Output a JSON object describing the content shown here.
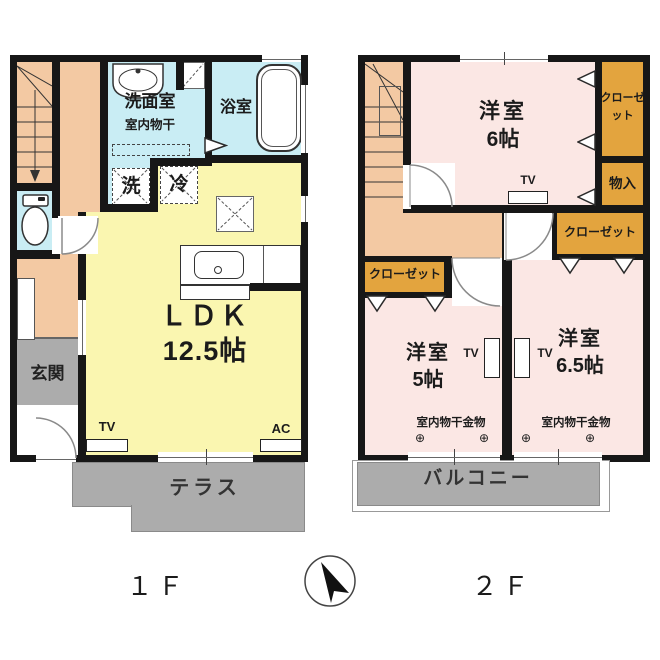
{
  "colors": {
    "wall": "#171717",
    "stairs_hall_fill": "#F3C9A3",
    "wet_area_fill": "#C9EDF4",
    "ldk_fill": "#FAF6B0",
    "bedroom_fill": "#FBE7E4",
    "closet_fill": "#E3A43E",
    "outdoor_fill": "#ACACAC"
  },
  "floor1": {
    "label": "１Ｆ",
    "ldk": {
      "name": "ＬＤＫ",
      "size": "12.5帖"
    },
    "washroom": {
      "name": "洗面室",
      "note": "室内物干"
    },
    "bathroom": "浴室",
    "washer": "洗",
    "fridge": "冷",
    "entrance": "玄関",
    "terrace": "テラス",
    "tv": "TV",
    "ac": "AC"
  },
  "floor2": {
    "label": "２Ｆ",
    "room6": {
      "name": "洋室",
      "size": "6帖"
    },
    "room5": {
      "name": "洋室",
      "size": "5帖"
    },
    "room65": {
      "name": "洋室",
      "size": "6.5帖"
    },
    "closet": "クローゼット",
    "storage": "物入",
    "balcony": "バルコニー",
    "drying_hw": "室内物干金物",
    "anchor": "⊕",
    "tv": "TV"
  }
}
